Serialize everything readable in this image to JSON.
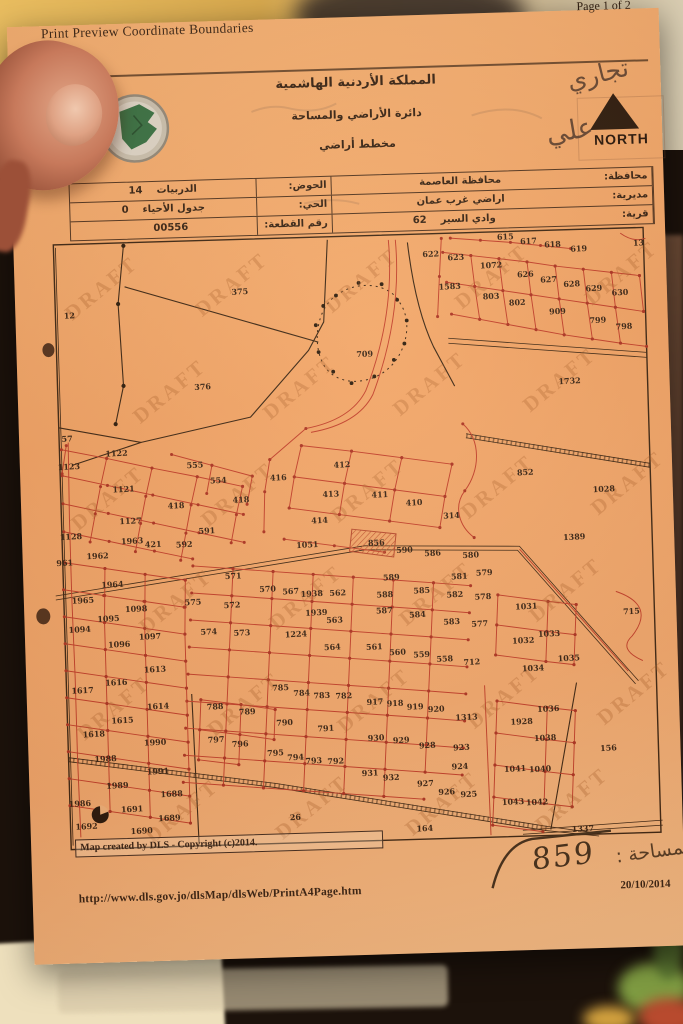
{
  "colors": {
    "paper": "#f2a76b",
    "ink": "#2f1d10",
    "line_red": "#c03a27",
    "dot_red": "#aa2f1f",
    "line_black": "#34200f",
    "draft": "#a65a24",
    "north": "#1d0f06"
  },
  "header": {
    "title": "Print Preview Coordinate Boundaries",
    "page_indicator": "Page 1 of 2"
  },
  "letterhead": {
    "kingdom": "المملكة الأردنية الهاشمية",
    "department": "دائرة الأراضي والمساحة",
    "doc_type": "مخطط أراضي"
  },
  "annotations": {
    "handwriting_top": "تجاري",
    "handwriting_side": "علي",
    "area_value": "859",
    "area_label": "المساحة :"
  },
  "compass": {
    "north_label": "NORTH"
  },
  "info_table": {
    "rows": [
      {
        "label_a": "محافظة:",
        "value_a": "محافظة العاصمة",
        "num_a": "",
        "label_b": "الحوض:",
        "value_b": "الدربيات",
        "num_b": "14"
      },
      {
        "label_a": "مديرية:",
        "value_a": "اراضي غرب عمان",
        "num_a": "",
        "label_b": "الحي:",
        "value_b": "جدول الأحياء",
        "num_b": "0"
      },
      {
        "label_a": "قرية:",
        "value_a": "وادي السير",
        "num_a": "62",
        "label_b": "رقم القطعة:",
        "value_b": "00556",
        "num_b": ""
      }
    ]
  },
  "map": {
    "watermark": "DRAFT",
    "credit": "Map created by DLS - Copyright (c)2014.",
    "parcels": [
      [
        "12",
        62,
        318
      ],
      [
        "375",
        233,
        299
      ],
      [
        "376",
        193,
        393
      ],
      [
        "709",
        356,
        365
      ],
      [
        "622",
        425,
        267
      ],
      [
        "623",
        450,
        271
      ],
      [
        "615",
        500,
        252
      ],
      [
        "617",
        523,
        257
      ],
      [
        "618",
        547,
        261
      ],
      [
        "619",
        573,
        266
      ],
      [
        "13",
        633,
        262
      ],
      [
        "1583",
        443,
        300
      ],
      [
        "1072",
        485,
        280
      ],
      [
        "626",
        519,
        290
      ],
      [
        "627",
        542,
        296
      ],
      [
        "628",
        565,
        301
      ],
      [
        "629",
        587,
        306
      ],
      [
        "630",
        613,
        311
      ],
      [
        "803",
        484,
        311
      ],
      [
        "802",
        510,
        318
      ],
      [
        "909",
        550,
        328
      ],
      [
        "799",
        590,
        338
      ],
      [
        "798",
        616,
        345
      ],
      [
        "1732",
        560,
        398
      ],
      [
        "57",
        56,
        441
      ],
      [
        "1122",
        105,
        457
      ],
      [
        "1123",
        57,
        469
      ],
      [
        "1121",
        111,
        493
      ],
      [
        "555",
        183,
        471
      ],
      [
        "554",
        206,
        487
      ],
      [
        "416",
        266,
        486
      ],
      [
        "418",
        228,
        507
      ],
      [
        "418",
        163,
        511
      ],
      [
        "1127",
        117,
        525
      ],
      [
        "1128",
        57,
        539
      ],
      [
        "1963",
        118,
        545
      ],
      [
        "421",
        139,
        549
      ],
      [
        "592",
        170,
        550
      ],
      [
        "591",
        193,
        537
      ],
      [
        "1962",
        83,
        559
      ],
      [
        "961",
        50,
        565
      ],
      [
        "412",
        330,
        475
      ],
      [
        "413",
        318,
        504
      ],
      [
        "411",
        367,
        506
      ],
      [
        "410",
        401,
        515
      ],
      [
        "414",
        306,
        530
      ],
      [
        "314",
        438,
        529
      ],
      [
        "1051",
        293,
        554
      ],
      [
        "856",
        362,
        554
      ],
      [
        "852",
        513,
        488
      ],
      [
        "1028",
        591,
        507
      ],
      [
        "1389",
        560,
        554
      ],
      [
        "1964",
        97,
        588
      ],
      [
        "1965",
        67,
        603
      ],
      [
        "1098",
        120,
        613
      ],
      [
        "1095",
        92,
        622
      ],
      [
        "1094",
        63,
        632
      ],
      [
        "1097",
        133,
        641
      ],
      [
        "1096",
        102,
        648
      ],
      [
        "1613",
        137,
        674
      ],
      [
        "1616",
        98,
        686
      ],
      [
        "1617",
        64,
        693
      ],
      [
        "571",
        218,
        583
      ],
      [
        "575",
        177,
        608
      ],
      [
        "572",
        216,
        612
      ],
      [
        "574",
        192,
        638
      ],
      [
        "573",
        225,
        640
      ],
      [
        "570",
        252,
        597
      ],
      [
        "567",
        275,
        600
      ],
      [
        "1938",
        296,
        603
      ],
      [
        "562",
        322,
        603
      ],
      [
        "1939",
        300,
        622
      ],
      [
        "563",
        318,
        630
      ],
      [
        "1224",
        279,
        643
      ],
      [
        "564",
        315,
        657
      ],
      [
        "590",
        390,
        562
      ],
      [
        "586",
        418,
        566
      ],
      [
        "589",
        376,
        589
      ],
      [
        "588",
        369,
        606
      ],
      [
        "585",
        406,
        603
      ],
      [
        "581",
        444,
        590
      ],
      [
        "582",
        439,
        608
      ],
      [
        "587",
        368,
        622
      ],
      [
        "584",
        401,
        627
      ],
      [
        "583",
        435,
        635
      ],
      [
        "561",
        357,
        658
      ],
      [
        "560",
        380,
        664
      ],
      [
        "559",
        404,
        667
      ],
      [
        "558",
        427,
        672
      ],
      [
        "712",
        454,
        676
      ],
      [
        "580",
        456,
        569
      ],
      [
        "579",
        469,
        587
      ],
      [
        "578",
        467,
        611
      ],
      [
        "577",
        463,
        638
      ],
      [
        "1031",
        510,
        622
      ],
      [
        "1033",
        532,
        650
      ],
      [
        "1032",
        506,
        656
      ],
      [
        "1035",
        551,
        675
      ],
      [
        "1034",
        515,
        684
      ],
      [
        "715",
        615,
        630
      ],
      [
        "1614",
        139,
        711
      ],
      [
        "1615",
        103,
        724
      ],
      [
        "1618",
        74,
        737
      ],
      [
        "1990",
        135,
        747
      ],
      [
        "1988",
        85,
        762
      ],
      [
        "1991",
        137,
        776
      ],
      [
        "1989",
        96,
        789
      ],
      [
        "1986",
        58,
        806
      ],
      [
        "1688",
        150,
        799
      ],
      [
        "1691",
        110,
        813
      ],
      [
        "1689",
        147,
        823
      ],
      [
        "1692",
        64,
        829
      ],
      [
        "1690",
        119,
        835
      ],
      [
        "788",
        196,
        713
      ],
      [
        "789",
        228,
        719
      ],
      [
        "797",
        196,
        746
      ],
      [
        "796",
        220,
        751
      ],
      [
        "785",
        262,
        696
      ],
      [
        "784",
        283,
        702
      ],
      [
        "783",
        303,
        705
      ],
      [
        "782",
        325,
        706
      ],
      [
        "790",
        265,
        731
      ],
      [
        "791",
        306,
        738
      ],
      [
        "917",
        356,
        713
      ],
      [
        "918",
        376,
        715
      ],
      [
        "919",
        396,
        719
      ],
      [
        "920",
        417,
        722
      ],
      [
        "1313",
        447,
        731
      ],
      [
        "930",
        356,
        749
      ],
      [
        "929",
        381,
        752
      ],
      [
        "928",
        407,
        758
      ],
      [
        "923",
        441,
        761
      ],
      [
        "795",
        255,
        761
      ],
      [
        "794",
        275,
        766
      ],
      [
        "793",
        293,
        770
      ],
      [
        "792",
        315,
        771
      ],
      [
        "931",
        349,
        784
      ],
      [
        "932",
        370,
        789
      ],
      [
        "927",
        404,
        796
      ],
      [
        "924",
        439,
        780
      ],
      [
        "926",
        425,
        805
      ],
      [
        "925",
        447,
        808
      ],
      [
        "26",
        273,
        826
      ],
      [
        "164",
        402,
        841
      ],
      [
        "1036",
        529,
        725
      ],
      [
        "1928",
        502,
        737
      ],
      [
        "1038",
        525,
        754
      ],
      [
        "1041",
        494,
        784
      ],
      [
        "1040",
        519,
        785
      ],
      [
        "1043",
        491,
        817
      ],
      [
        "1042",
        515,
        818
      ],
      [
        "156",
        588,
        766
      ],
      [
        "1337",
        560,
        846
      ]
    ]
  },
  "footer": {
    "url": "http://www.dls.gov.jo/dlsMap/dlsWeb/PrintA4Page.htm",
    "date": "20/10/2014"
  }
}
